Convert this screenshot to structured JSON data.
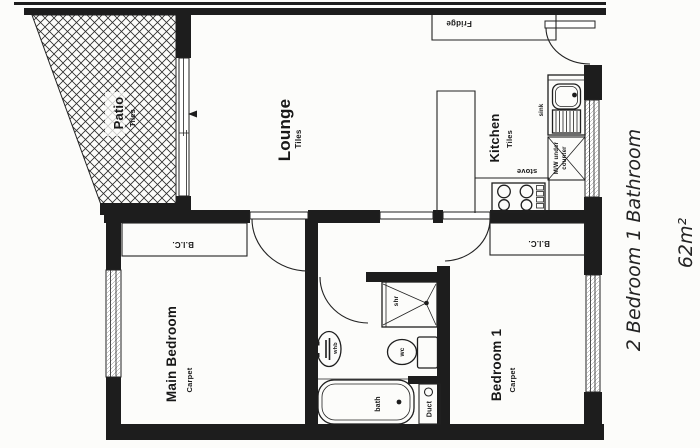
{
  "plan": {
    "rooms": {
      "patio": {
        "name": "Patio",
        "floor": "Tiles"
      },
      "lounge": {
        "name": "Lounge",
        "floor": "Tiles"
      },
      "kitchen": {
        "name": "Kitchen",
        "floor": "Tiles"
      },
      "main_bedroom": {
        "name": "Main Bedroom",
        "floor": "Carpet"
      },
      "bedroom1": {
        "name": "Bedroom 1",
        "floor": "Carpet"
      }
    },
    "fixtures": {
      "fridge": "Fridge",
      "stove": "stove",
      "sink": "sink",
      "microwave_line1": "M/W under",
      "microwave_line2": "counter",
      "shower": "shr",
      "basin": "whb",
      "toilet": "wc",
      "bath": "bath",
      "duct": "Duct"
    },
    "closets": {
      "main_bedroom": "B.I.C.",
      "bedroom1": "B.I.C."
    },
    "annotation": {
      "title": "2 Bedroom 1 Bathroom",
      "area": "62m²"
    },
    "colors": {
      "ink": "#1d1d1d",
      "paper": "#fcfcfa"
    }
  }
}
